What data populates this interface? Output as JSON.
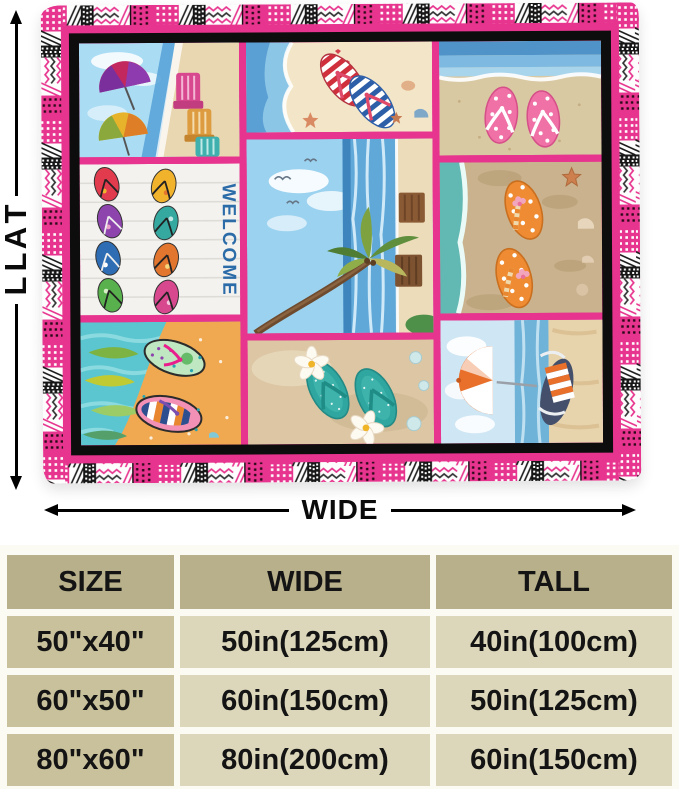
{
  "product_figure": {
    "tall_label": "TALL",
    "wide_label": "WIDE",
    "blanket": {
      "welcome_text": "WELCOME",
      "panels": [
        "beach-chairs-umbrellas",
        "striped-flip-flops",
        "pink-polkadot-flip-flops",
        "welcome-flip-flops",
        "palm-tree-beach",
        "orange-polkadot-flip-flops",
        "tropical-art-flip-flops",
        "teal-plumeria-flip-flops",
        "beach-umbrella-chair"
      ]
    }
  },
  "size_table": {
    "headers": [
      "SIZE",
      "WIDE",
      "TALL"
    ],
    "rows": [
      [
        "50\"x40\"",
        "50in(125cm)",
        "40in(100cm)"
      ],
      [
        "60\"x50\"",
        "60in(150cm)",
        "50in(125cm)"
      ],
      [
        "80\"x60\"",
        "80in(200cm)",
        "60in(150cm)"
      ]
    ]
  },
  "colors": {
    "accent_pink": "#e7348e",
    "frame_black": "#0d0d0d",
    "table_header_bg": "#b7b08a",
    "table_size_col_bg": "#c8c19b",
    "table_cell_bg": "#dcd7ba"
  }
}
